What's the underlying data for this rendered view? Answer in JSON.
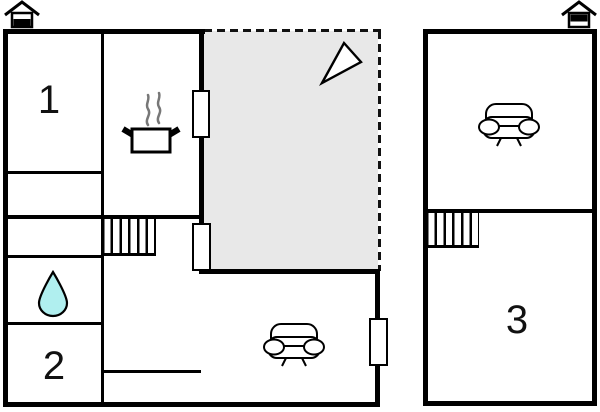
{
  "diagram": {
    "type": "floor-plan",
    "ground_floor": {
      "rooms": [
        {
          "number": "1"
        },
        {
          "number": "2"
        }
      ],
      "icons": [
        "entrance-house",
        "kitchen-pot",
        "steam",
        "stairs",
        "water-drop",
        "sofa",
        "north-arrow"
      ],
      "areas": [
        "terrace"
      ]
    },
    "upper_floor": {
      "rooms": [
        {
          "number": "3"
        }
      ],
      "icons": [
        "entrance-house",
        "stairs",
        "sofa"
      ]
    },
    "colors": {
      "wall": "#000000",
      "terrace_fill": "#E8E8E8",
      "water_drop_fill": "#B0EFEF",
      "steam": "#777777",
      "background": "#FFFFFF"
    }
  }
}
